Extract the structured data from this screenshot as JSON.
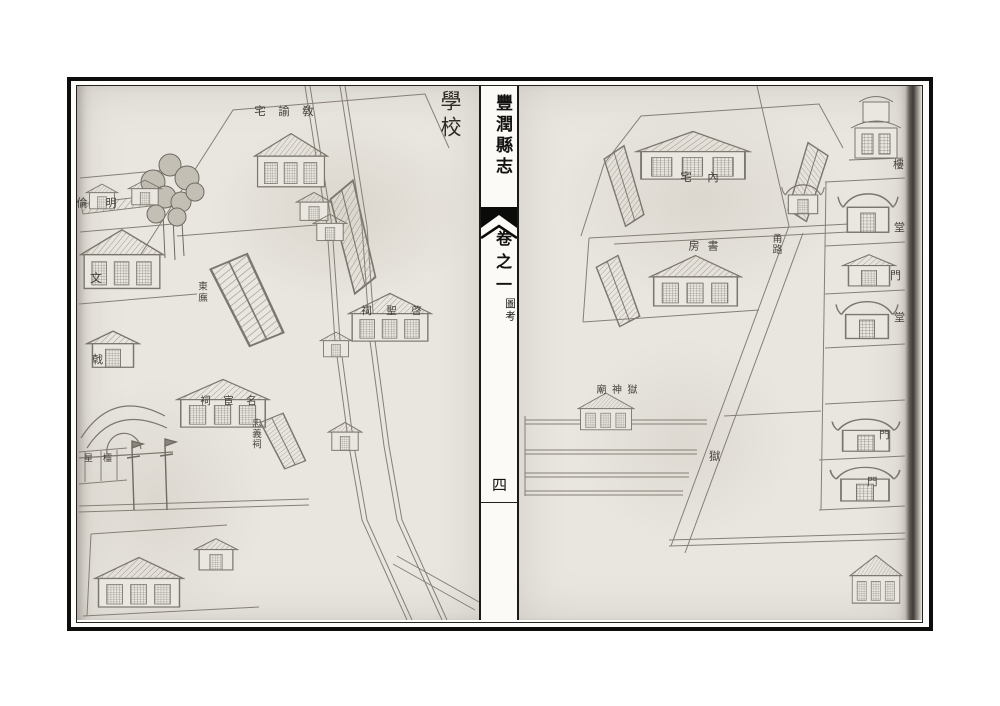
{
  "spine": {
    "title": "豐潤縣志",
    "volume": "卷之一",
    "section": "圖考",
    "folio": "四"
  },
  "left_map": {
    "title": "學校",
    "labels": {
      "instructor_residence": "敎諭宅",
      "minglun_hall": "明倫",
      "wen": "文",
      "east_wing": "東廡",
      "qisheng_shrine": "啓聖祠",
      "minghuan_shrine": "名宦祠",
      "zhongyi_shrine": "忠義祠",
      "ji_gate": "戟",
      "lingxing_gate": "欞星"
    }
  },
  "right_map": {
    "labels": {
      "inner_residence": "內宅",
      "study": "書房",
      "path": "甬路",
      "jail_god_temple": "獄神廟",
      "jail": "獄",
      "tower": "樓",
      "hall_upper": "堂",
      "gate_upper": "門",
      "hall_mid": "堂",
      "gate_mid": "門",
      "gate_lower": "門"
    }
  },
  "colors": {
    "frame_ink": "#0d0d0c",
    "paper": "#e9e6e0",
    "drawing_ink": "#827d74",
    "label_ink": "#45413b"
  }
}
